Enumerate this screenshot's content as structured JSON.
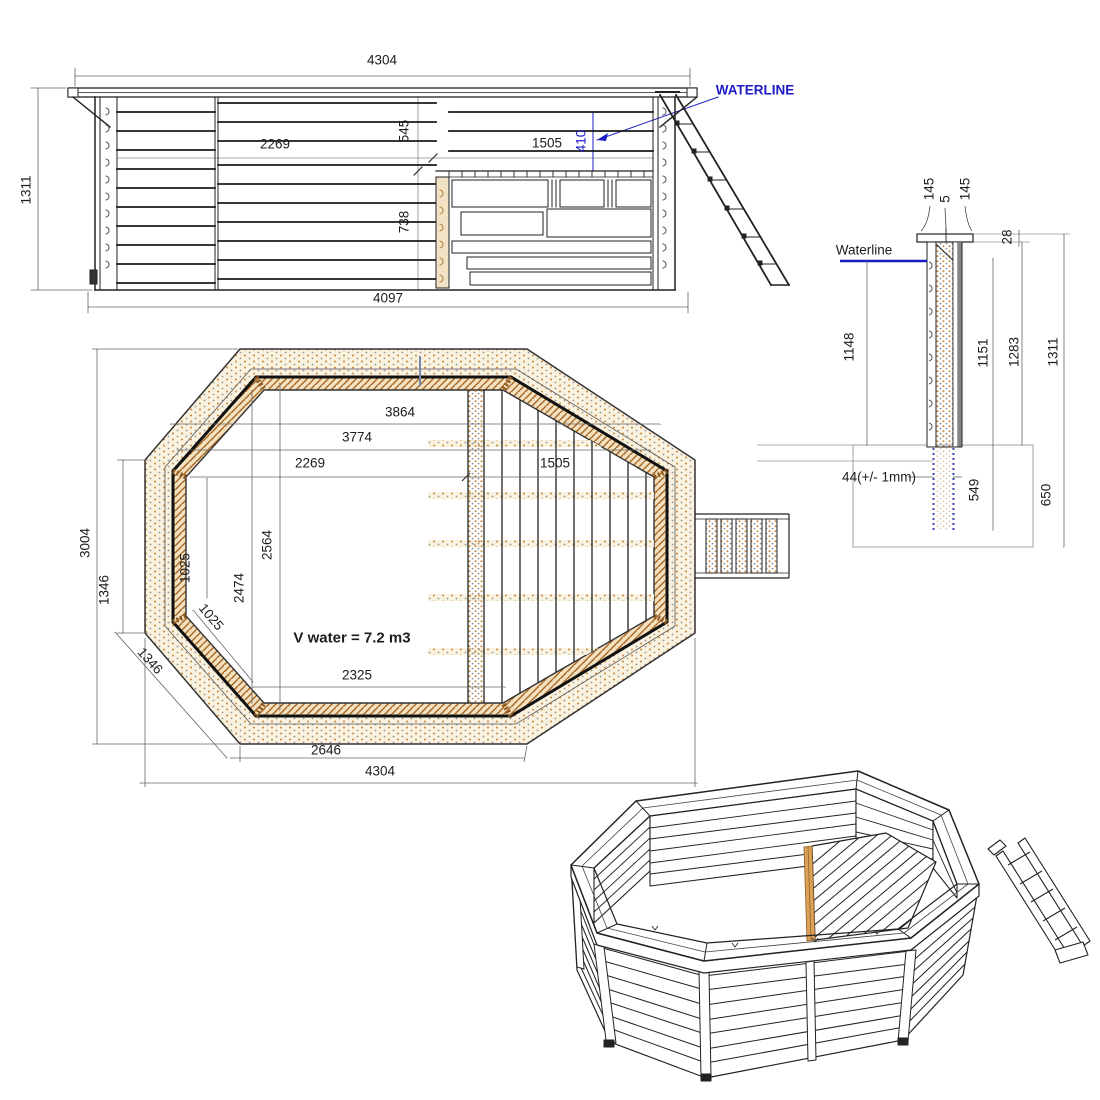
{
  "drawing_title": "octagonal-wooden-pool-technical-drawing",
  "colors": {
    "line": "#222222",
    "dim_line": "#666666",
    "wood_dot": "#c8873c",
    "wood_hatch": "#a86a28",
    "wood_fill": "#f3e3c6",
    "blue_annotation": "#1b1bc4",
    "ground_line": "#999999"
  },
  "elevation": {
    "dim_top": "4304",
    "dim_left": "1311",
    "dim_inner": "2269",
    "dim_mid_upper": "545",
    "dim_deck": "1505",
    "dim_water": "410",
    "dim_mid_lower": "738",
    "dim_bottom": "4097",
    "waterline_label": "WATERLINE"
  },
  "plan": {
    "dim_top1": "3864",
    "dim_top2": "3774",
    "dim_top3": "2269",
    "dim_top4": "1505",
    "dim_left_total": "3004",
    "dim_left_side": "1346",
    "dim_left_inner": "1025",
    "dim_diag_inner": "1025",
    "dim_height1": "2474",
    "dim_height2": "2564",
    "volume_label": "V water = 7.2 m3",
    "dim_bottom_inner": "2325",
    "dim_diag_side": "1346",
    "dim_bottom_mid": "2646",
    "dim_bottom_total": "4304"
  },
  "section": {
    "dim_cap_left": "145",
    "dim_cap_gap": "5",
    "dim_cap_right": "145",
    "dim_cap_thickness": "28",
    "waterline_label": "Waterline",
    "dim_water_depth": "1148",
    "dim_1151": "1151",
    "dim_1283": "1283",
    "dim_total_height": "1311",
    "dim_embed": "549",
    "dim_foundation": "650",
    "dim_plank": "44(+/- 1mm)"
  }
}
